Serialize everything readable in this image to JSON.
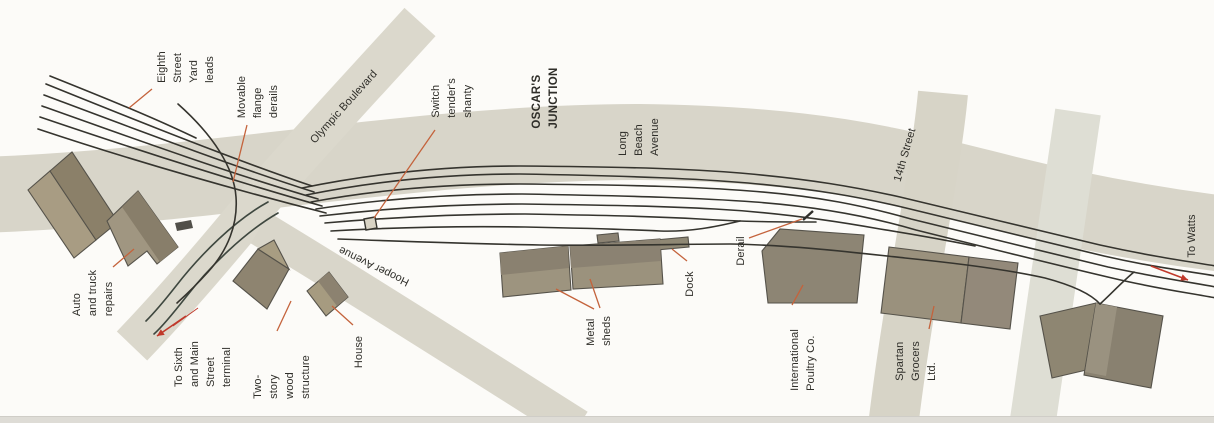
{
  "page": {
    "bottom_strip_color": "#dedcd6",
    "background_color": "#fcfbf8"
  },
  "map": {
    "title_label": "OSCAR'S JUNCTION",
    "colors": {
      "track": "#35342e",
      "street_track": "#3e473f",
      "leader": "#c4633c",
      "arrow": "#c0392b",
      "label_text": "#2f2e29",
      "building_stroke": "#55524a",
      "road_main": "#d8d5c9"
    },
    "roads": [
      {
        "id": "long-beach-avenue",
        "d": "M-20,195 C200,188 420,142 640,142 C820,144 900,167 1000,192 C1080,212 1160,226 1224,234",
        "width": 76,
        "color": "#d8d5c9"
      },
      {
        "id": "unnamed-cross-street",
        "d": "M1078,112 C1065,200 1046,330 1032,427",
        "width": 46,
        "color": "#deded4"
      },
      {
        "id": "fourteenth-street",
        "d": "M943,93 C936,170 908,300 893,427",
        "width": 50,
        "color": "#d7d4c7"
      },
      {
        "id": "olympic-boulevard-terminal-street",
        "d": "M420,22 C360,88 300,152 262,197 C226,241 176,300 132,346",
        "width": 42,
        "color": "#dbd8cc"
      },
      {
        "id": "hooper-avenue",
        "d": "M260,228 C340,276 460,352 578,427",
        "width": 36,
        "color": "#d9d6ca"
      }
    ],
    "buildings": [
      {
        "id": "auto-repairs-building-a",
        "points": "28,190 50,171 96,240 74,258",
        "fill": "#a89c83"
      },
      {
        "id": "auto-repairs-building-a2",
        "points": "50,171 72,152 118,222 96,240",
        "fill": "#8b8069"
      },
      {
        "id": "auto-repairs-building-b",
        "points": "107,221 138,191 178,247 157,264 147,251 128,266",
        "fill": "#a09681"
      },
      {
        "id": "two-story-wood-structure",
        "points": "233,281 258,249 289,269 267,309",
        "fill": "#8e8470"
      },
      {
        "id": "two-story-gable",
        "points": "258,249 274,240 289,269",
        "fill": "#a89d82"
      },
      {
        "id": "house-building",
        "points": "307,291 329,272 348,297 326,316",
        "fill": "#a69b80"
      },
      {
        "id": "metal-shed-left",
        "points": "500,253 568,246 571,290 503,297",
        "fill": "#9d947f"
      },
      {
        "id": "metal-shed-right",
        "points": "570,246 660,239 663,284 573,289",
        "fill": "#9b927d"
      },
      {
        "id": "metal-shed-bump",
        "points": "597,235 618,233 619,241 598,243",
        "fill": "#8b8272"
      },
      {
        "id": "dock-structure",
        "points": "655,240 688,237 689,247 656,250",
        "fill": "#8f8874"
      },
      {
        "id": "international-poultry-building",
        "points": "762,251 780,229 864,235 857,303 768,303",
        "fill": "#8d8574"
      },
      {
        "id": "spartan-grocers-left",
        "points": "889,247 969,257 961,323 881,313",
        "fill": "#9a917d"
      },
      {
        "id": "spartan-grocers-right",
        "points": "969,257 1018,263 1010,329 961,323",
        "fill": "#93897a"
      },
      {
        "id": "right-building-left",
        "points": "1040,316 1096,303 1108,365 1052,378",
        "fill": "#8e8672"
      },
      {
        "id": "right-building-right",
        "points": "1096,303 1163,316 1151,388 1084,375",
        "fill": "#898170"
      }
    ],
    "building_overlays": [
      {
        "id": "auto-repairs-b-shade",
        "points": "122,207 138,191 178,247 160,262",
        "fill": "#887e6a"
      },
      {
        "id": "house-shade",
        "points": "318,281 329,272 348,297 337,306",
        "fill": "#8c8270"
      },
      {
        "id": "shed-left-shade",
        "points": "500,253 568,246 569,268 501,275",
        "fill": "#8a8170"
      },
      {
        "id": "shed-right-shade",
        "points": "570,246 660,239 661,261 571,268",
        "fill": "#8b8272"
      },
      {
        "id": "right-building-light-strip",
        "points": "1096,303 1117,307 1106,376 1085,372",
        "fill": "#9a9280"
      }
    ],
    "tracks": [
      {
        "id": "yard-lead-0",
        "d": "M50,76 C100,96 150,116 196,138"
      },
      {
        "id": "yard-lead-1",
        "d": "M46,84 C140,122 235,160 312,186"
      },
      {
        "id": "yard-lead-2",
        "d": "M44,95 C140,131 235,167 314,192"
      },
      {
        "id": "yard-lead-3",
        "d": "M42,106 C140,141 235,175 318,199"
      },
      {
        "id": "yard-lead-4",
        "d": "M40,117 C140,151 238,182 322,206"
      },
      {
        "id": "yard-lead-5",
        "d": "M38,129 C140,163 240,191 326,213"
      },
      {
        "id": "main-1",
        "d": "M302,188 C380,172 450,166 520,166 C640,167 690,169 740,173 C810,179 855,187 900,197 C960,211 1040,231 1100,245 C1150,256 1185,261 1216,266"
      },
      {
        "id": "main-2",
        "d": "M306,195 C380,180 450,174 520,174 C640,176 700,179 748,183 C815,189 860,197 906,208 C965,222 1045,242 1104,256 C1152,267 1186,271 1216,276"
      },
      {
        "id": "main-3",
        "d": "M311,202 C380,189 450,184 520,184 C640,185 700,187 750,191 C818,196 865,206 911,219 C970,233 1048,253 1108,267 C1155,277 1188,282 1216,287"
      },
      {
        "id": "main-4",
        "d": "M316,209 C382,199 452,194 522,194 C640,196 700,198 755,202 C822,207 872,217 916,230 C976,245 1052,264 1112,278 C1158,289 1190,293 1216,298"
      },
      {
        "id": "yard-track-5",
        "d": "M320,216 C390,208 452,204 522,204 C600,205 660,206 715,209 C770,212 830,220 880,229 C930,237 955,242 975,246"
      },
      {
        "id": "yard-track-6",
        "d": "M325,223 C395,217 455,214 525,214 C585,215 645,216 700,219 C745,222 785,222 816,222"
      },
      {
        "id": "yard-track-7",
        "d": "M331,231 C400,227 460,226 525,227 C575,228 620,229 660,231 C690,232 715,227 740,221"
      },
      {
        "id": "siding",
        "d": "M338,239 C420,242 480,244 540,245 C620,246 680,244 730,244 C790,245 850,252 905,258 C955,263 1005,269 1045,278 C1075,286 1092,295 1100,304"
      },
      {
        "id": "right-spur",
        "d": "M1134,272 C1122,282 1112,293 1100,304"
      },
      {
        "id": "street-track-1",
        "d": "M268,202 C235,220 200,255 176,286 C165,300 153,314 146,321",
        "color": "#3e473f"
      },
      {
        "id": "street-track-2",
        "d": "M278,213 C245,232 210,266 186,297 C175,311 163,326 154,334",
        "color": "#3e473f"
      },
      {
        "id": "wrap-track",
        "d": "M178,104 C214,136 234,168 236,197 C238,224 228,250 208,272 C199,282 188,293 177,303"
      }
    ],
    "marks": [
      {
        "id": "switch-tenders-shanty",
        "type": "polygon",
        "points": "364,219 375,217 377,228 366,230",
        "fill": "#d8d3c4",
        "stroke": "#35342e"
      },
      {
        "id": "parked-car",
        "type": "polygon",
        "points": "175,223 191,220 193,228 177,231",
        "fill": "#514f49",
        "stroke": "none"
      },
      {
        "id": "derail-tick",
        "type": "line",
        "x1": 803,
        "y1": 220,
        "x2": 813,
        "y2": 211,
        "width": 2.4,
        "color": "#2f2e29"
      }
    ],
    "leaders": [
      {
        "id": "leader-eighth-street",
        "x1": 152,
        "y1": 89,
        "x2": 129,
        "y2": 108
      },
      {
        "id": "leader-movable-derails",
        "x1": 247,
        "y1": 125,
        "x2": 233,
        "y2": 182
      },
      {
        "id": "leader-switch-shanty",
        "x1": 435,
        "y1": 130,
        "x2": 374,
        "y2": 218
      },
      {
        "id": "leader-auto-repairs",
        "x1": 113,
        "y1": 267,
        "x2": 134,
        "y2": 249
      },
      {
        "id": "leader-two-story",
        "x1": 277,
        "y1": 331,
        "x2": 291,
        "y2": 301
      },
      {
        "id": "leader-house",
        "x1": 353,
        "y1": 325,
        "x2": 332,
        "y2": 306
      },
      {
        "id": "leader-metal-sheds-1",
        "x1": 594,
        "y1": 309,
        "x2": 556,
        "y2": 289
      },
      {
        "id": "leader-metal-sheds-2",
        "x1": 600,
        "y1": 308,
        "x2": 590,
        "y2": 279
      },
      {
        "id": "leader-dock",
        "x1": 687,
        "y1": 261,
        "x2": 672,
        "y2": 249
      },
      {
        "id": "leader-derail",
        "x1": 749,
        "y1": 238,
        "x2": 802,
        "y2": 219
      },
      {
        "id": "leader-poultry",
        "x1": 792,
        "y1": 305,
        "x2": 803,
        "y2": 285
      },
      {
        "id": "leader-spartan",
        "x1": 929,
        "y1": 329,
        "x2": 934,
        "y2": 306
      }
    ],
    "arrows": [
      {
        "id": "arrow-to-terminal",
        "x1": 186,
        "y1": 316,
        "x2": 157,
        "y2": 336,
        "width": 1.6
      },
      {
        "id": "arrow-to-terminal-ghost",
        "x1": 198,
        "y1": 308,
        "x2": 173,
        "y2": 326,
        "width": 0.9,
        "nohead": true
      },
      {
        "id": "arrow-to-watts",
        "x1": 1151,
        "y1": 266,
        "x2": 1188,
        "y2": 280,
        "width": 1.6
      }
    ],
    "labels": [
      {
        "id": "label-eighth-street-yard-leads",
        "text": "Eighth\nStreet\nYard\nleads",
        "x": 186,
        "y": 67,
        "rot": -90,
        "bold": false
      },
      {
        "id": "label-movable-flange-derails",
        "text": "Movable\nflange\nderails",
        "x": 258,
        "y": 97,
        "rot": -90,
        "bold": false
      },
      {
        "id": "label-olympic-boulevard",
        "text": "Olympic Boulevard",
        "x": 344,
        "y": 107,
        "rot": -48,
        "bold": false
      },
      {
        "id": "label-switch-tenders-shanty",
        "text": "Switch\ntender's\nshanty",
        "x": 452,
        "y": 98,
        "rot": -90,
        "bold": false
      },
      {
        "id": "label-oscars-junction",
        "text": "OSCAR'S\nJUNCTION",
        "x": 546,
        "y": 98,
        "rot": -90,
        "bold": true
      },
      {
        "id": "label-long-beach-avenue",
        "text": "Long\nBeach\nAvenue",
        "x": 639,
        "y": 137,
        "rot": -90,
        "bold": false
      },
      {
        "id": "label-14th-street",
        "text": "14th Street",
        "x": 905,
        "y": 155,
        "rot": -74,
        "bold": false
      },
      {
        "id": "label-to-watts",
        "text": "To Watts",
        "x": 1192,
        "y": 236,
        "rot": -90,
        "bold": false
      },
      {
        "id": "label-auto-truck-repairs",
        "text": "Auto\nand truck\nrepairs",
        "x": 93,
        "y": 293,
        "rot": -90,
        "bold": false
      },
      {
        "id": "label-to-sixth-main",
        "text": "To Sixth\nand Main\nStreet\nterminal",
        "x": 203,
        "y": 364,
        "rot": -90,
        "bold": false
      },
      {
        "id": "label-two-story-wood",
        "text": "Two-\nstory\nwood\nstructure",
        "x": 282,
        "y": 377,
        "rot": -90,
        "bold": false
      },
      {
        "id": "label-house",
        "text": "House",
        "x": 359,
        "y": 352,
        "rot": -90,
        "bold": false
      },
      {
        "id": "label-hooper-avenue",
        "text": "Hooper Avenue",
        "x": 374,
        "y": 266,
        "rot": 206,
        "bold": false
      },
      {
        "id": "label-metal-sheds",
        "text": "Metal\nsheds",
        "x": 599,
        "y": 331,
        "rot": -90,
        "bold": false
      },
      {
        "id": "label-dock",
        "text": "Dock",
        "x": 690,
        "y": 284,
        "rot": -90,
        "bold": false
      },
      {
        "id": "label-derail",
        "text": "Derail",
        "x": 741,
        "y": 251,
        "rot": -90,
        "bold": false
      },
      {
        "id": "label-international-poultry",
        "text": "International\nPoultry Co.",
        "x": 803,
        "y": 360,
        "rot": -90,
        "bold": false
      },
      {
        "id": "label-spartan-grocers",
        "text": "Spartan\nGrocers\nLtd.",
        "x": 916,
        "y": 361,
        "rot": -90,
        "bold": false
      }
    ]
  }
}
